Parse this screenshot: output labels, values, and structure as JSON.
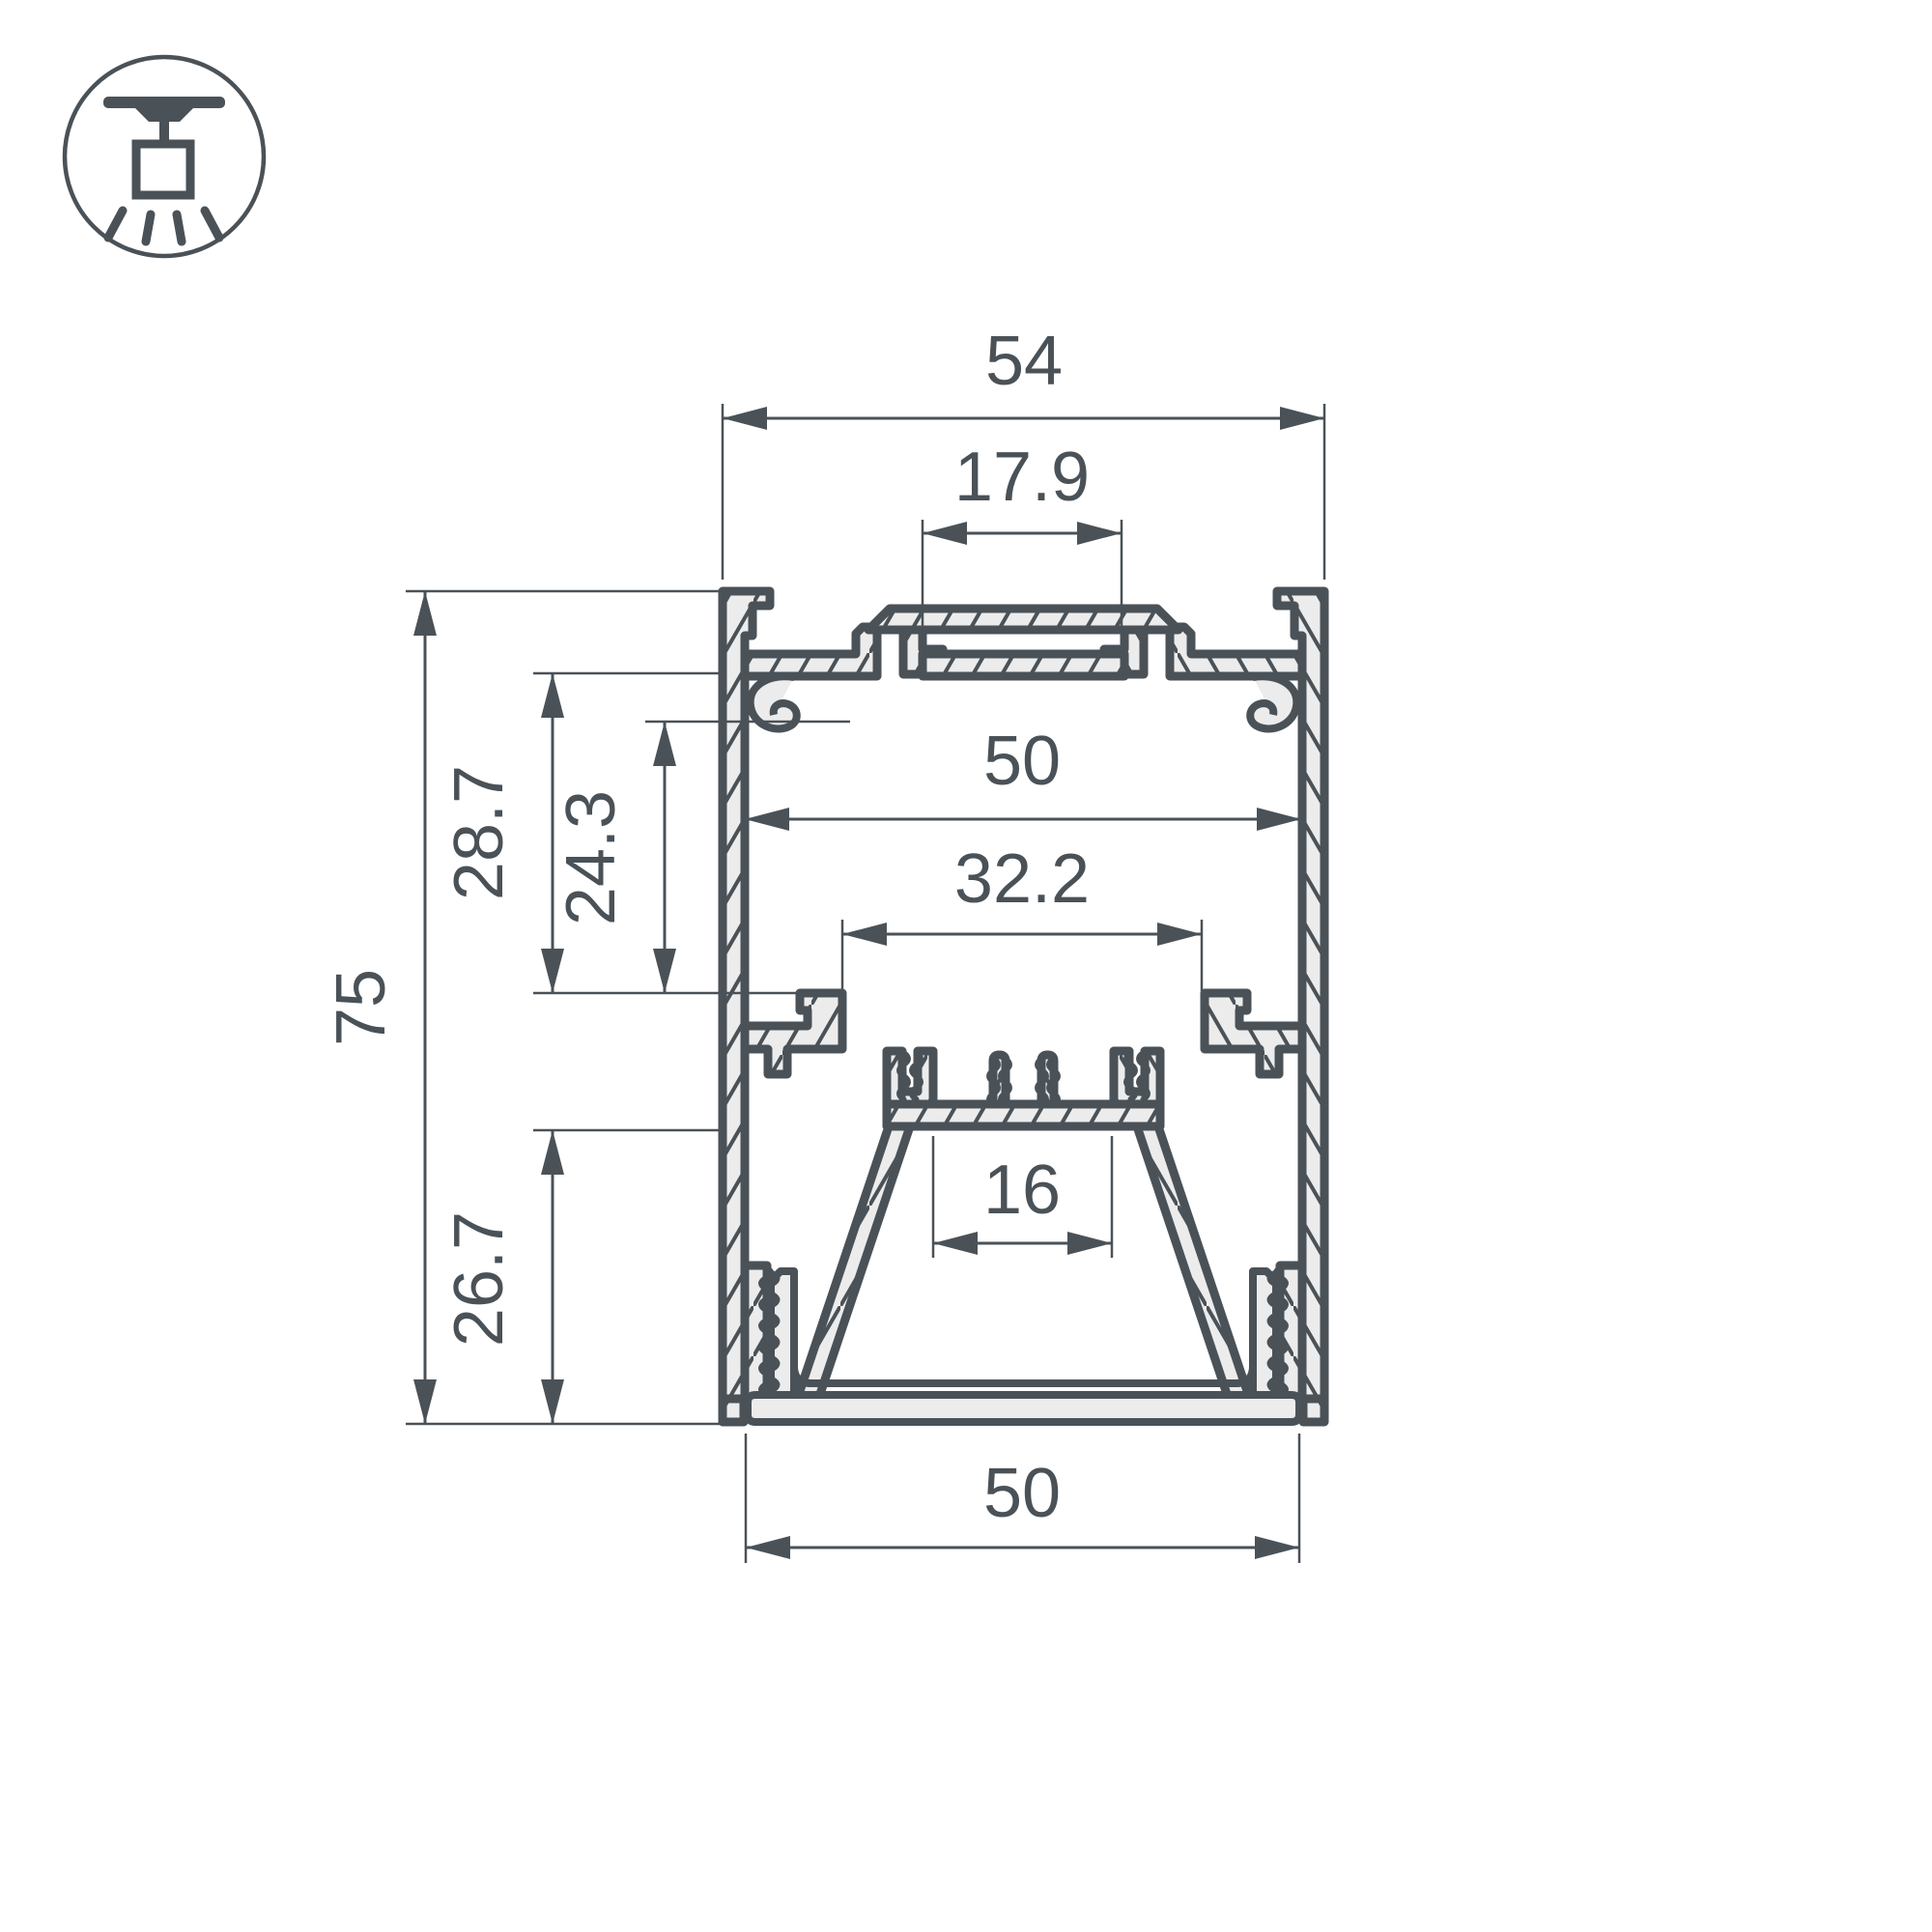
{
  "drawing": {
    "type": "profile-cross-section",
    "colors": {
      "line": "#4a5258",
      "fill": "#ececec",
      "background": "#ffffff"
    },
    "icon": {
      "name": "pendant-ceiling-light-icon"
    },
    "dimensions": {
      "top_width": {
        "label": "54"
      },
      "slot_width": {
        "label": "17.9"
      },
      "inner_width": {
        "label": "50"
      },
      "ledge_width": {
        "label": "32.2"
      },
      "led_seat_width": {
        "label": "16"
      },
      "bottom_width": {
        "label": "50"
      },
      "total_height": {
        "label": "75"
      },
      "upper_depth": {
        "label": "28.7"
      },
      "boss_depth": {
        "label": "24.3"
      },
      "lower_depth": {
        "label": "26.7"
      }
    }
  }
}
